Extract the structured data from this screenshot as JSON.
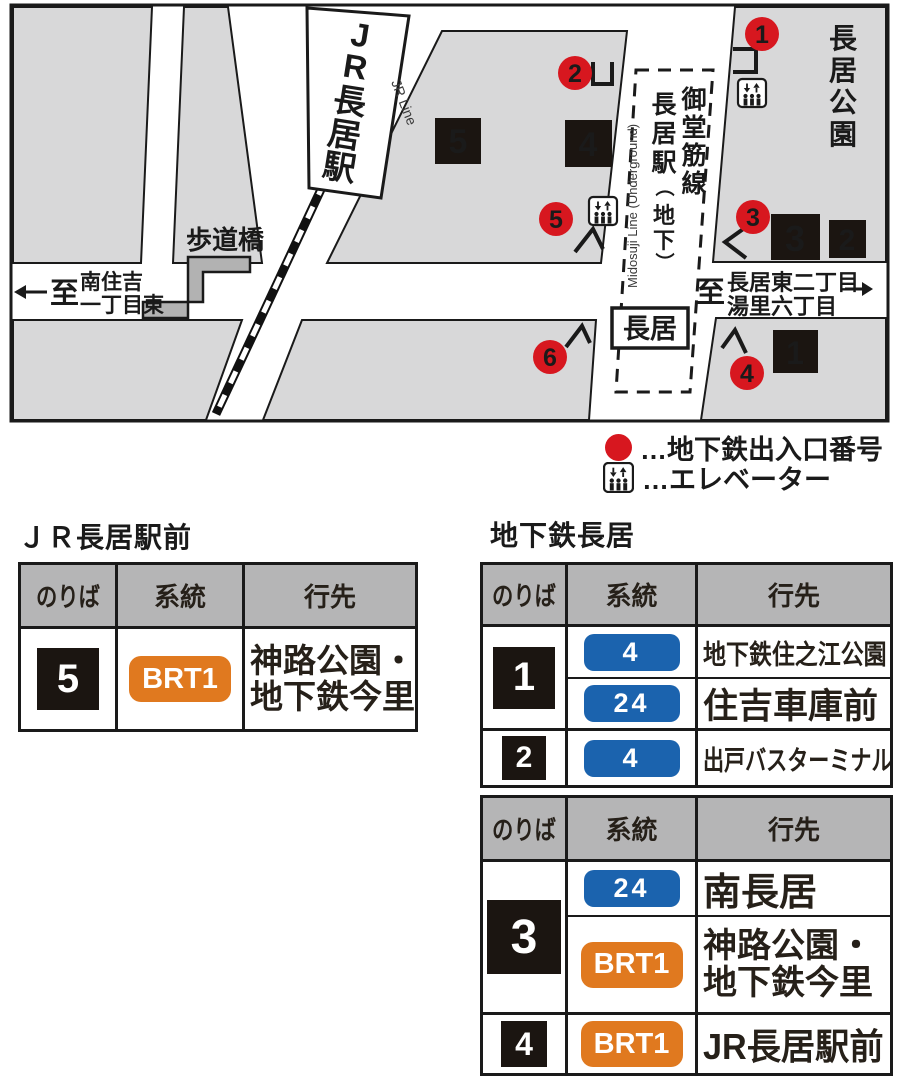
{
  "map": {
    "jr_station_chars": [
      "J",
      "R",
      "長",
      "居",
      "駅"
    ],
    "jr_line_en": "JR Line",
    "park_chars": [
      "長",
      "居",
      "公",
      "園"
    ],
    "midosuji_chars": [
      "御",
      "堂",
      "筋",
      "線"
    ],
    "nagai_sta_chars": [
      "長",
      "居",
      "駅"
    ],
    "paren_open": "（",
    "chika_chars": [
      "地",
      "下"
    ],
    "paren_close": "）",
    "metro_en": "Midosuji Line (Underground)",
    "hodokyo_label": "歩道橋",
    "nagai_box_label": "長居",
    "left_dir": {
      "to": "至",
      "line1": "南住吉",
      "line2": "一丁目東"
    },
    "right_dir": {
      "to": "至",
      "line1": "長居東二丁目",
      "line2": "湯里六丁目"
    },
    "exit_numbers": [
      "1",
      "2",
      "3",
      "4",
      "5",
      "6"
    ],
    "stop_numbers": [
      "1",
      "2",
      "3",
      "4",
      "5"
    ]
  },
  "legend": {
    "exit_label": "…地下鉄出入口番号",
    "elevator_label": "…エレベーター"
  },
  "jr_area": {
    "title": "ＪＲ長居駅前",
    "h_stop": "のりば",
    "h_route": "系統",
    "h_dest": "行先",
    "stop": "5",
    "route": "BRT1",
    "dest_l1": "神路公園・",
    "dest_l2": "地下鉄今里"
  },
  "subway_area": {
    "title": "地下鉄長居",
    "t1": {
      "h_stop": "のりば",
      "h_route": "系統",
      "h_dest": "行先",
      "stop_a": "1",
      "r1": "4",
      "d1": "地下鉄住之江公園",
      "r2": "24",
      "d2": "住吉車庫前",
      "stop_b": "2",
      "r3": "4",
      "d3": "出戸バスターミナル"
    },
    "t2": {
      "h_stop": "のりば",
      "h_route": "系統",
      "h_dest": "行先",
      "stop_a": "3",
      "r1": "24",
      "d1": "南長居",
      "r2": "BRT1",
      "d2_l1": "神路公園・",
      "d2_l2": "地下鉄今里",
      "stop_b": "4",
      "r3": "BRT1",
      "d3": "JR長居駅前"
    }
  },
  "colors": {
    "exit_red": "#d7171f",
    "route_blue": "#1b63ae",
    "route_orange": "#e0791f",
    "square_black": "#1b1511",
    "header_gray": "#b5b5b6",
    "block_gray": "#d8d8d9"
  }
}
